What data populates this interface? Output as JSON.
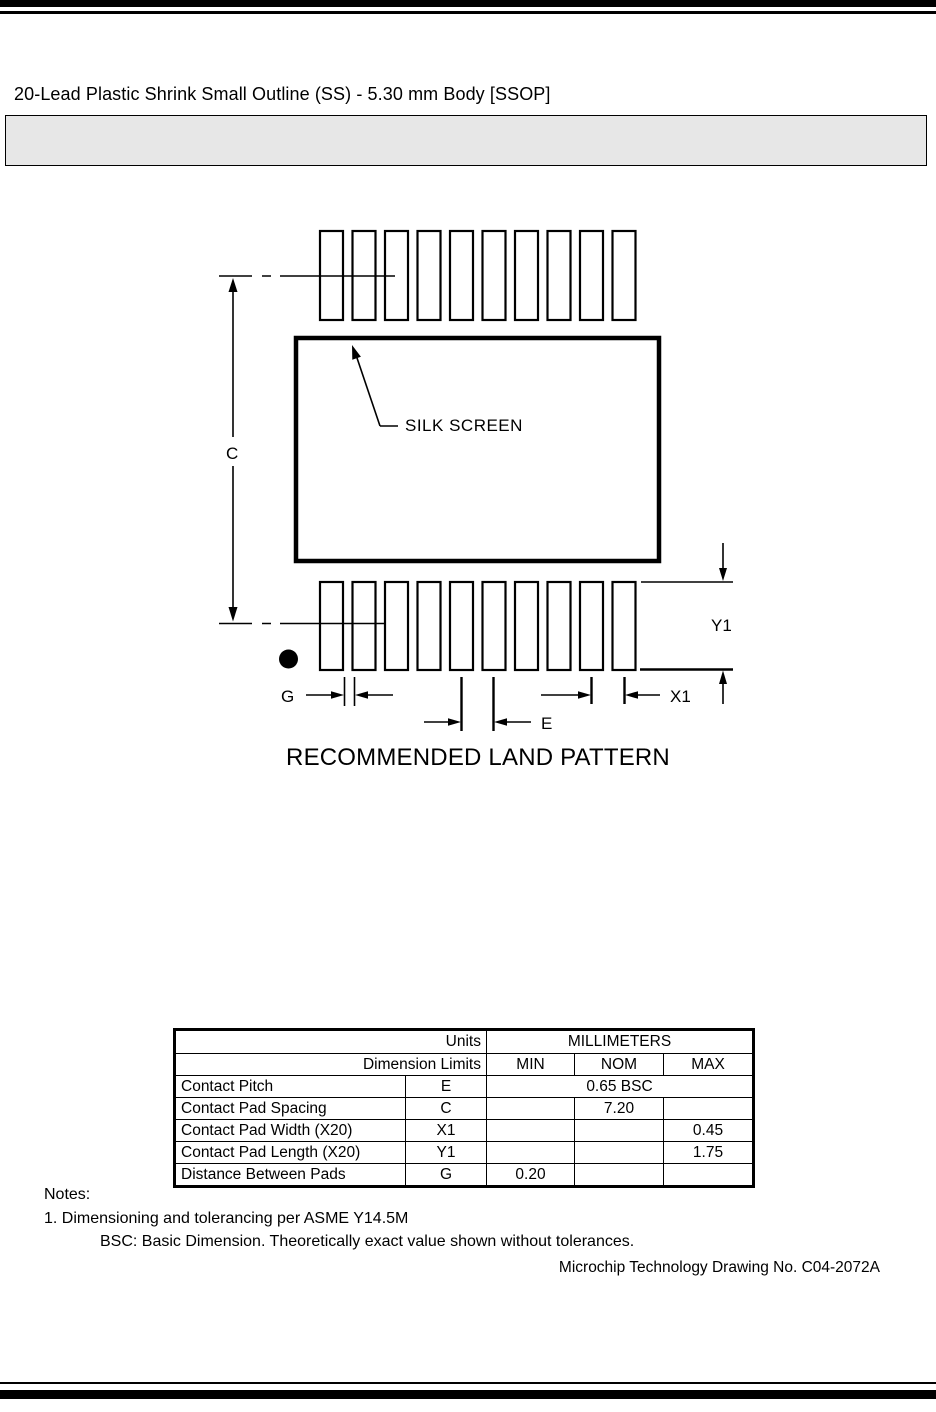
{
  "page": {
    "title": "20-Lead Plastic Shrink Small Outline (SS) - 5.30 mm Body [SSOP]"
  },
  "drawing": {
    "caption": "RECOMMENDED LAND PATTERN",
    "silk_screen_label": "SILK SCREEN",
    "pads_per_row": 10,
    "pad_rows": 2,
    "dimension_labels": {
      "contact_pad_spacing": "C",
      "pad_length": "Y1",
      "gap": "G",
      "pitch": "E",
      "pad_width": "X1"
    }
  },
  "table": {
    "header": {
      "units_label": "Units",
      "units_value": "MILLIMETERS",
      "dimension_limits_label": "Dimension Limits",
      "min": "MIN",
      "nom": "NOM",
      "max": "MAX"
    },
    "rows": [
      {
        "name": "Contact Pitch",
        "symbol": "E",
        "value_span": "0.65 BSC"
      },
      {
        "name": "Contact Pad Spacing",
        "symbol": "C",
        "min": "",
        "nom": "7.20",
        "max": ""
      },
      {
        "name": "Contact Pad Width (X20)",
        "symbol": "X1",
        "min": "",
        "nom": "",
        "max": "0.45"
      },
      {
        "name": "Contact Pad Length (X20)",
        "symbol": "Y1",
        "min": "",
        "nom": "",
        "max": "1.75"
      },
      {
        "name": "Distance Between Pads",
        "symbol": "G",
        "min": "0.20",
        "nom": "",
        "max": ""
      }
    ]
  },
  "notes": {
    "heading": "Notes:",
    "note1": "1. Dimensioning and tolerancing per ASME Y14.5M",
    "note2": "BSC: Basic Dimension. Theoretically exact value shown without tolerances."
  },
  "footer": {
    "drawing_number": "Microchip Technology Drawing No. C04-2072A"
  }
}
